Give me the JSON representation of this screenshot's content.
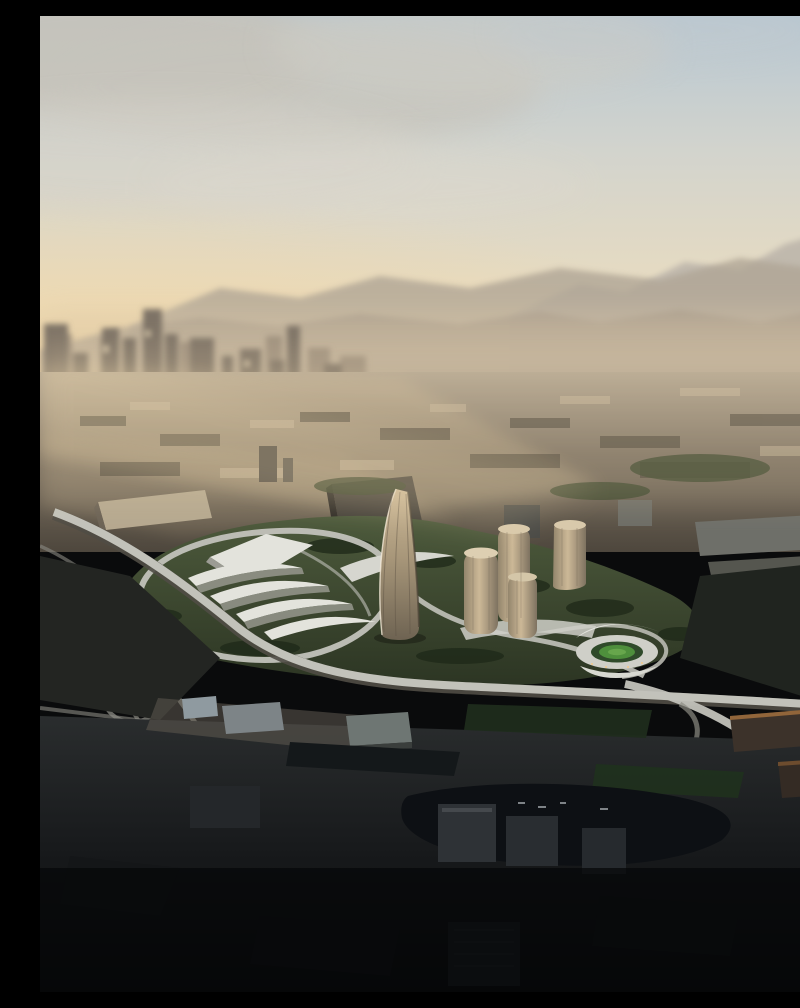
{
  "image": {
    "kind": "aerial-architectural-rendering",
    "subjects": [
      "sunset-hazy-sky",
      "distant-mountain-ranges",
      "downtown-skyline",
      "urban-sprawl",
      "futuristic-development-site",
      "sail-shaped-main-tower",
      "cylindrical-tower-cluster",
      "white-terraced-shell-buildings",
      "soccer-stadium-with-green-pitch",
      "freeway-interchange",
      "elevated-viaducts",
      "dark-foreground-city",
      "dark-water-inlet"
    ]
  },
  "scene": {
    "palette": {
      "skyTop": "#b7c7d2",
      "skyMid": "#d3d4cd",
      "skyWarm": "#e9dcc0",
      "sunGlow": "#f2d6a2",
      "cloudGrey": "#c7c3b9",
      "mountainFar": "#bdb6ab",
      "mountainMid": "#b0a696",
      "mountainNear": "#a3988a",
      "hazeBand": "#ddc9a9",
      "skyline": "#7e7366",
      "skylineLight": "#998b7a",
      "sprawlTop": "#b2a591",
      "sprawlBottom": "#4e473d",
      "siteGreenLight": "#4d5a3c",
      "siteGreenDark": "#2c3523",
      "shellWhite": "#e3e3dc",
      "shellShadow": "#9c9c94",
      "towerBronzeLight": "#ccb897",
      "towerBronzeMid": "#a8977a",
      "towerBronzeDark": "#6e6352",
      "roadLight": "#c2c2ba",
      "roadMid": "#8b8b83",
      "roadDark": "#5e625f",
      "stadiumPitch": "#4e8f3c",
      "foregroundDark": "#17191b",
      "foregroundBlack": "#08090a",
      "waterDark": "#0d1014",
      "warmRoof": "#9a6a3c",
      "boxRoofBlue": "#8f9aa0",
      "boxRoofGrey": "#7d8487"
    }
  }
}
